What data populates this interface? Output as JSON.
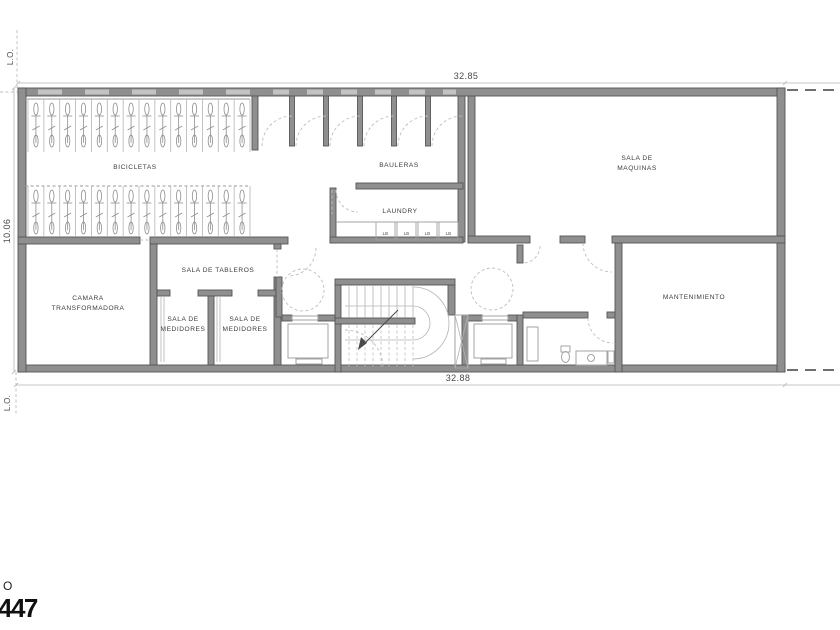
{
  "drawing": {
    "type": "architectural-floor-plan",
    "level": "basement-services"
  },
  "labels": {
    "bicicletas": "BICICLETAS",
    "bauleras": "BAULERAS",
    "laundry": "LAUNDRY",
    "maquinas_l1": "SALA DE",
    "maquinas_l2": "MAQUINAS",
    "camara_l1": "CAMARA",
    "camara_l2": "TRANSFORMADORA",
    "tableros": "SALA DE TABLEROS",
    "medidores_a_l1": "SALA DE",
    "medidores_a_l2": "MEDIDORES",
    "medidores_b_l1": "SALA DE",
    "medidores_b_l2": "MEDIDORES",
    "mantenimiento": "MANTENIMIENTO",
    "washer": "LB"
  },
  "dims": {
    "top": "32.85",
    "bottom": "32.88",
    "left": "10.06",
    "lot_line": "L.O."
  },
  "title_block": {
    "partial_letter": "O",
    "partial_number": "447"
  },
  "counts": {
    "bike_rows": 2,
    "bike_stalls_per_row": 14,
    "bauleras_units": 6,
    "washers": 4,
    "stair_treads": 9
  },
  "colors": {
    "wall": "#8f8f8f",
    "wall_edge": "#565656",
    "thin_line": "#a3a3a3",
    "light_line": "#b3b3b3",
    "dashed_line": "#bdbdbd",
    "label_text": "#3c3c3c"
  }
}
